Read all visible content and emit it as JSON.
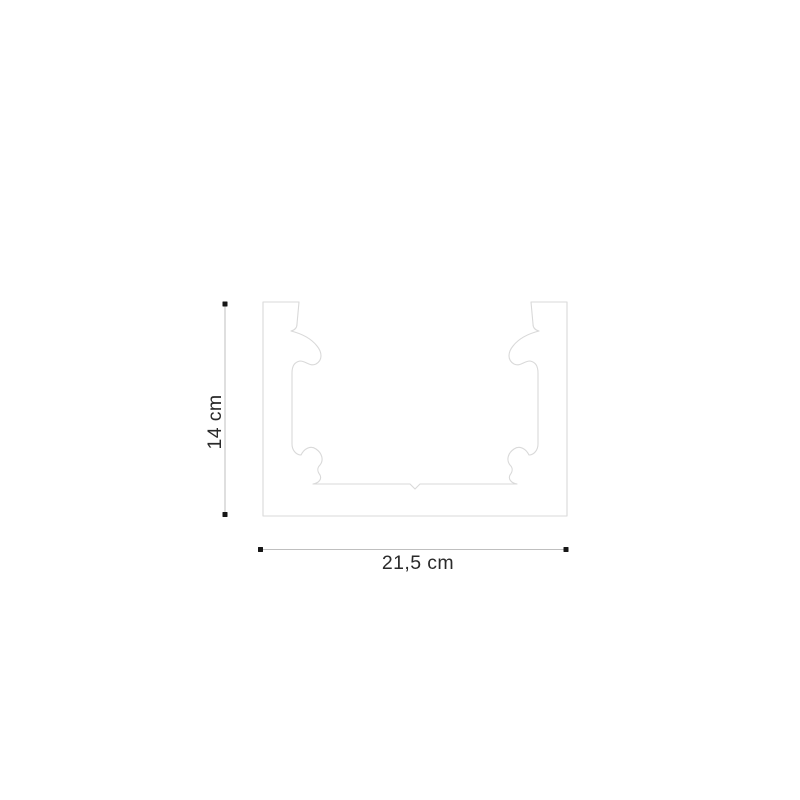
{
  "figure": {
    "dimensions": {
      "height": {
        "label": "14 cm"
      },
      "width": {
        "label": "21,5 cm"
      }
    },
    "colors": {
      "background": "#ffffff",
      "profile_fill": "#ffffff",
      "profile_outline": "#d9d9d9",
      "dimension_line": "#bfbfbf",
      "dimension_dot": "#161616",
      "label_text": "#2a2a2a"
    }
  }
}
